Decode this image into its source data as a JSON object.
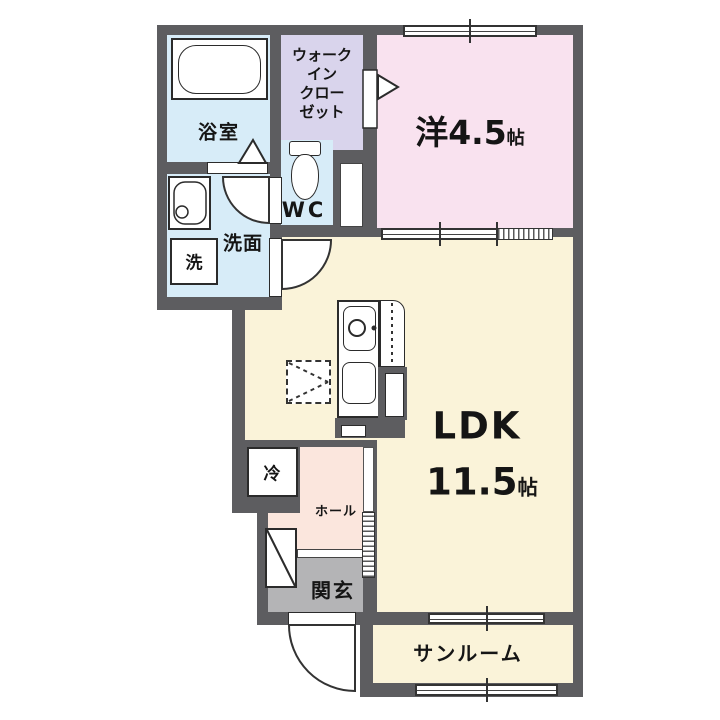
{
  "plan": {
    "type": "japanese-apartment-floor-plan",
    "rooms": {
      "bathroom": {
        "label": "浴室"
      },
      "walk_in_closet": {
        "label_lines": [
          "ウォーク",
          "イン",
          "クロー",
          "ゼット"
        ]
      },
      "wc": {
        "label": "WC"
      },
      "washroom": {
        "label": "洗面"
      },
      "washer": {
        "label": "洗"
      },
      "western_room": {
        "label": "洋4.5",
        "unit": "帖"
      },
      "ldk": {
        "label": "LDK",
        "size": "11.5",
        "unit": "帖"
      },
      "fridge": {
        "label": "冷"
      },
      "hall": {
        "label": "ホール"
      },
      "entrance": {
        "label": "関玄"
      },
      "sunroom": {
        "label": "サンルーム"
      }
    },
    "colors": {
      "wall": "#5d5d60",
      "wet_rooms_blue": "#d7ecf8",
      "closet_purple": "#d9d4ec",
      "western_room_pink": "#f9e2ef",
      "ldk_cream": "#faf3d9",
      "hall_peach": "#fbe6dd",
      "entrance_gray": "#b4b4b6"
    }
  }
}
